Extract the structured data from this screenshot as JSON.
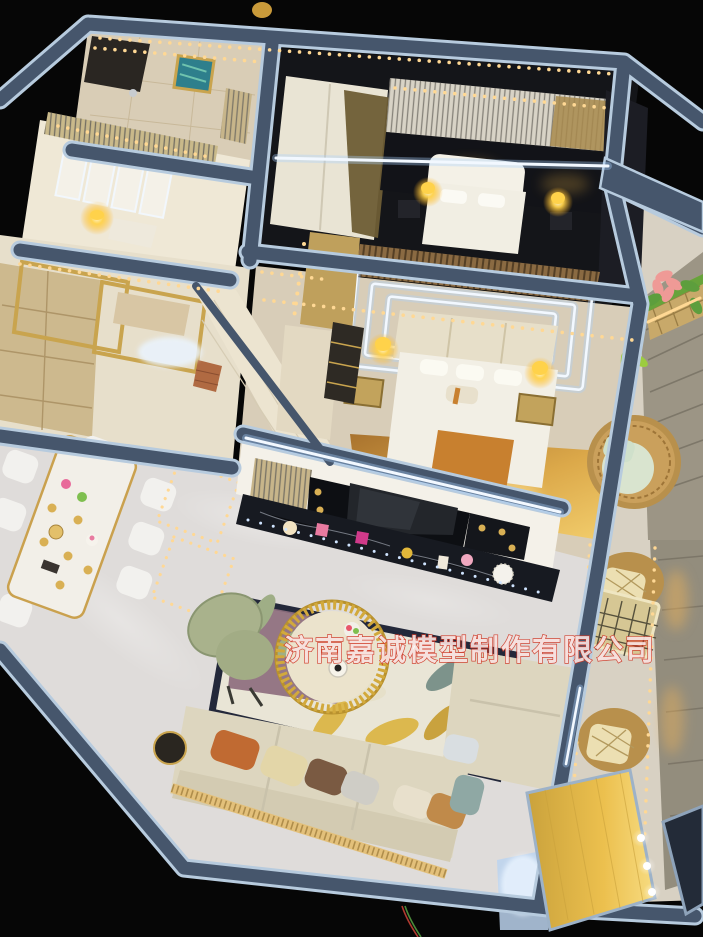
{
  "watermark": {
    "text": "济南嘉诚模型制作有限公司",
    "fill_color": "rgba(255,255,255,0.85)",
    "outline_color": "#cf3a28"
  },
  "palette": {
    "background": "#060606",
    "wall_slate": "#46566c",
    "wall_rim": "#b7cbde",
    "cream_wall": "#ece4d0",
    "gold_trim": "#c9a44e",
    "marble_floor": "#dfdcda",
    "wood_glow": "#e5b254",
    "led_warm": "#ffd894",
    "led_white": "#f2f8ff",
    "bed_white": "#f2efe5",
    "accent_orange": "#c8802f",
    "sofa_cream": "#ddd6bf",
    "stone_wall": "#9c9585",
    "rattan": "#b8904c",
    "mint_cushion": "#d5e2cd",
    "tv_black": "#171a21",
    "rug_mauve": "#8d6e7e",
    "rug_sage": "#9fae86",
    "rug_yellow": "#dcb84e",
    "green_chair": "#a9b28c",
    "wm_fill": "rgba(255,255,255,0.85)",
    "wm_red": "#cf3a28"
  }
}
